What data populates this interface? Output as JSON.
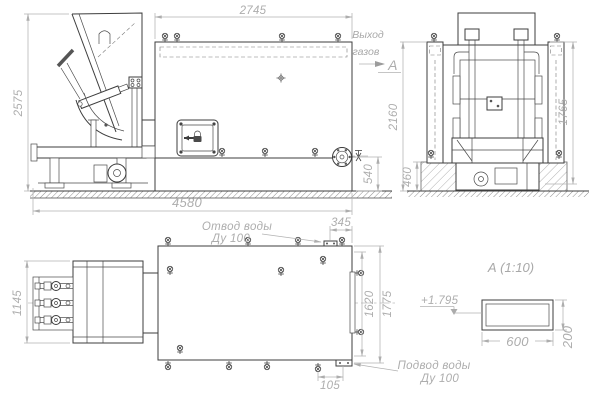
{
  "views": {
    "front": {
      "dim_body_width": "2745",
      "dim_feeder_height": "2575",
      "dim_overall_length": "4580",
      "dim_outlet_height": "540",
      "label_gas_outlet_1": "Выход",
      "label_gas_outlet_2": "газов",
      "section_letter": "А"
    },
    "side": {
      "dim_height": "2160",
      "dim_body_height": "1765",
      "dim_foundation": "460"
    },
    "plan": {
      "dim_feeder_width": "1145",
      "dim_outlet_offset": "345",
      "dim_width_inner": "1620",
      "dim_width_overall": "1775",
      "dim_inlet_offset": "105",
      "label_water_outlet_1": "Отвод воды",
      "label_water_outlet_2": "Ду 100",
      "label_water_inlet_1": "Подвод воды",
      "label_water_inlet_2": "Ду 100"
    },
    "detail": {
      "title": "А  (1:10)",
      "dim_width": "600",
      "dim_height": "200",
      "elevation": "+1.795"
    }
  },
  "colors": {
    "background": "#ffffff",
    "line": "#3d3d3d",
    "dimension": "#b0b0b0",
    "hatch": "#8f8f8f"
  }
}
